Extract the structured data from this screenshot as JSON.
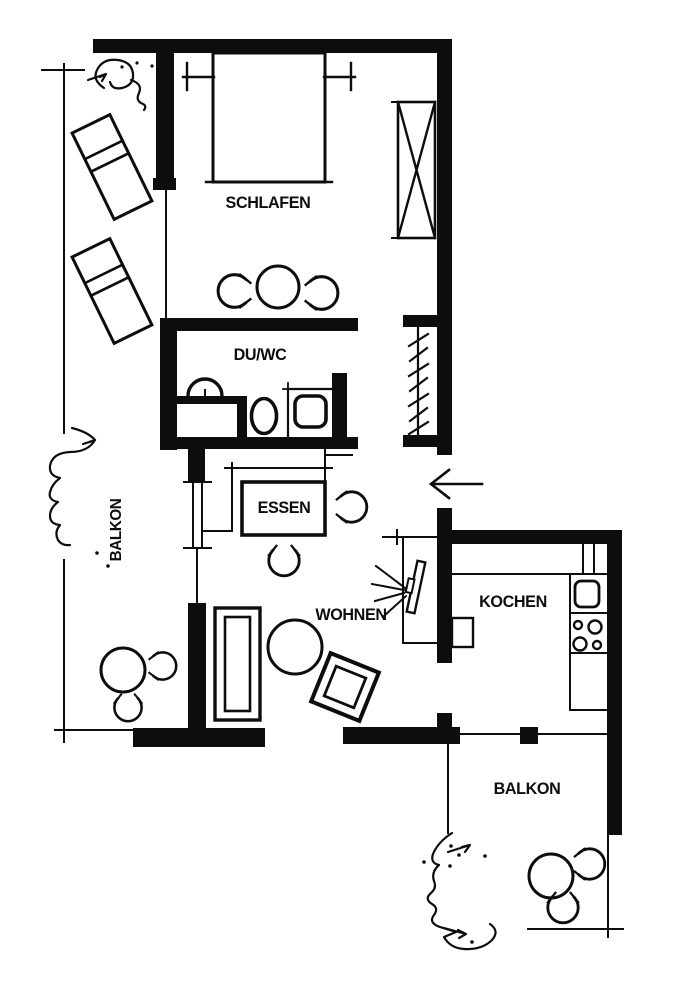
{
  "plan": {
    "type": "apartment-floorplan",
    "rooms": {
      "bedroom": {
        "label": "SCHLAFEN"
      },
      "bathroom": {
        "label": "DU/WC"
      },
      "balcony_left": {
        "label": "BALKON"
      },
      "dining": {
        "label": "ESSEN"
      },
      "living": {
        "label": "WOHNEN"
      },
      "kitchen": {
        "label": "KOCHEN"
      },
      "balcony_bottom": {
        "label": "BALKON"
      }
    },
    "colors": {
      "ink": "#0d0d0d",
      "paper": "#ffffff"
    },
    "furniture_icons": [
      "double-bed",
      "nightstand",
      "wardrobe",
      "coat-rack",
      "round-table",
      "chair",
      "washbasin",
      "toilet",
      "shower",
      "dining-table",
      "tv",
      "sofa",
      "coffee-table",
      "armchair",
      "lounge-chair",
      "kitchen-counter",
      "kitchen-sink",
      "stove",
      "fridge",
      "plant",
      "entry-arrow"
    ]
  }
}
